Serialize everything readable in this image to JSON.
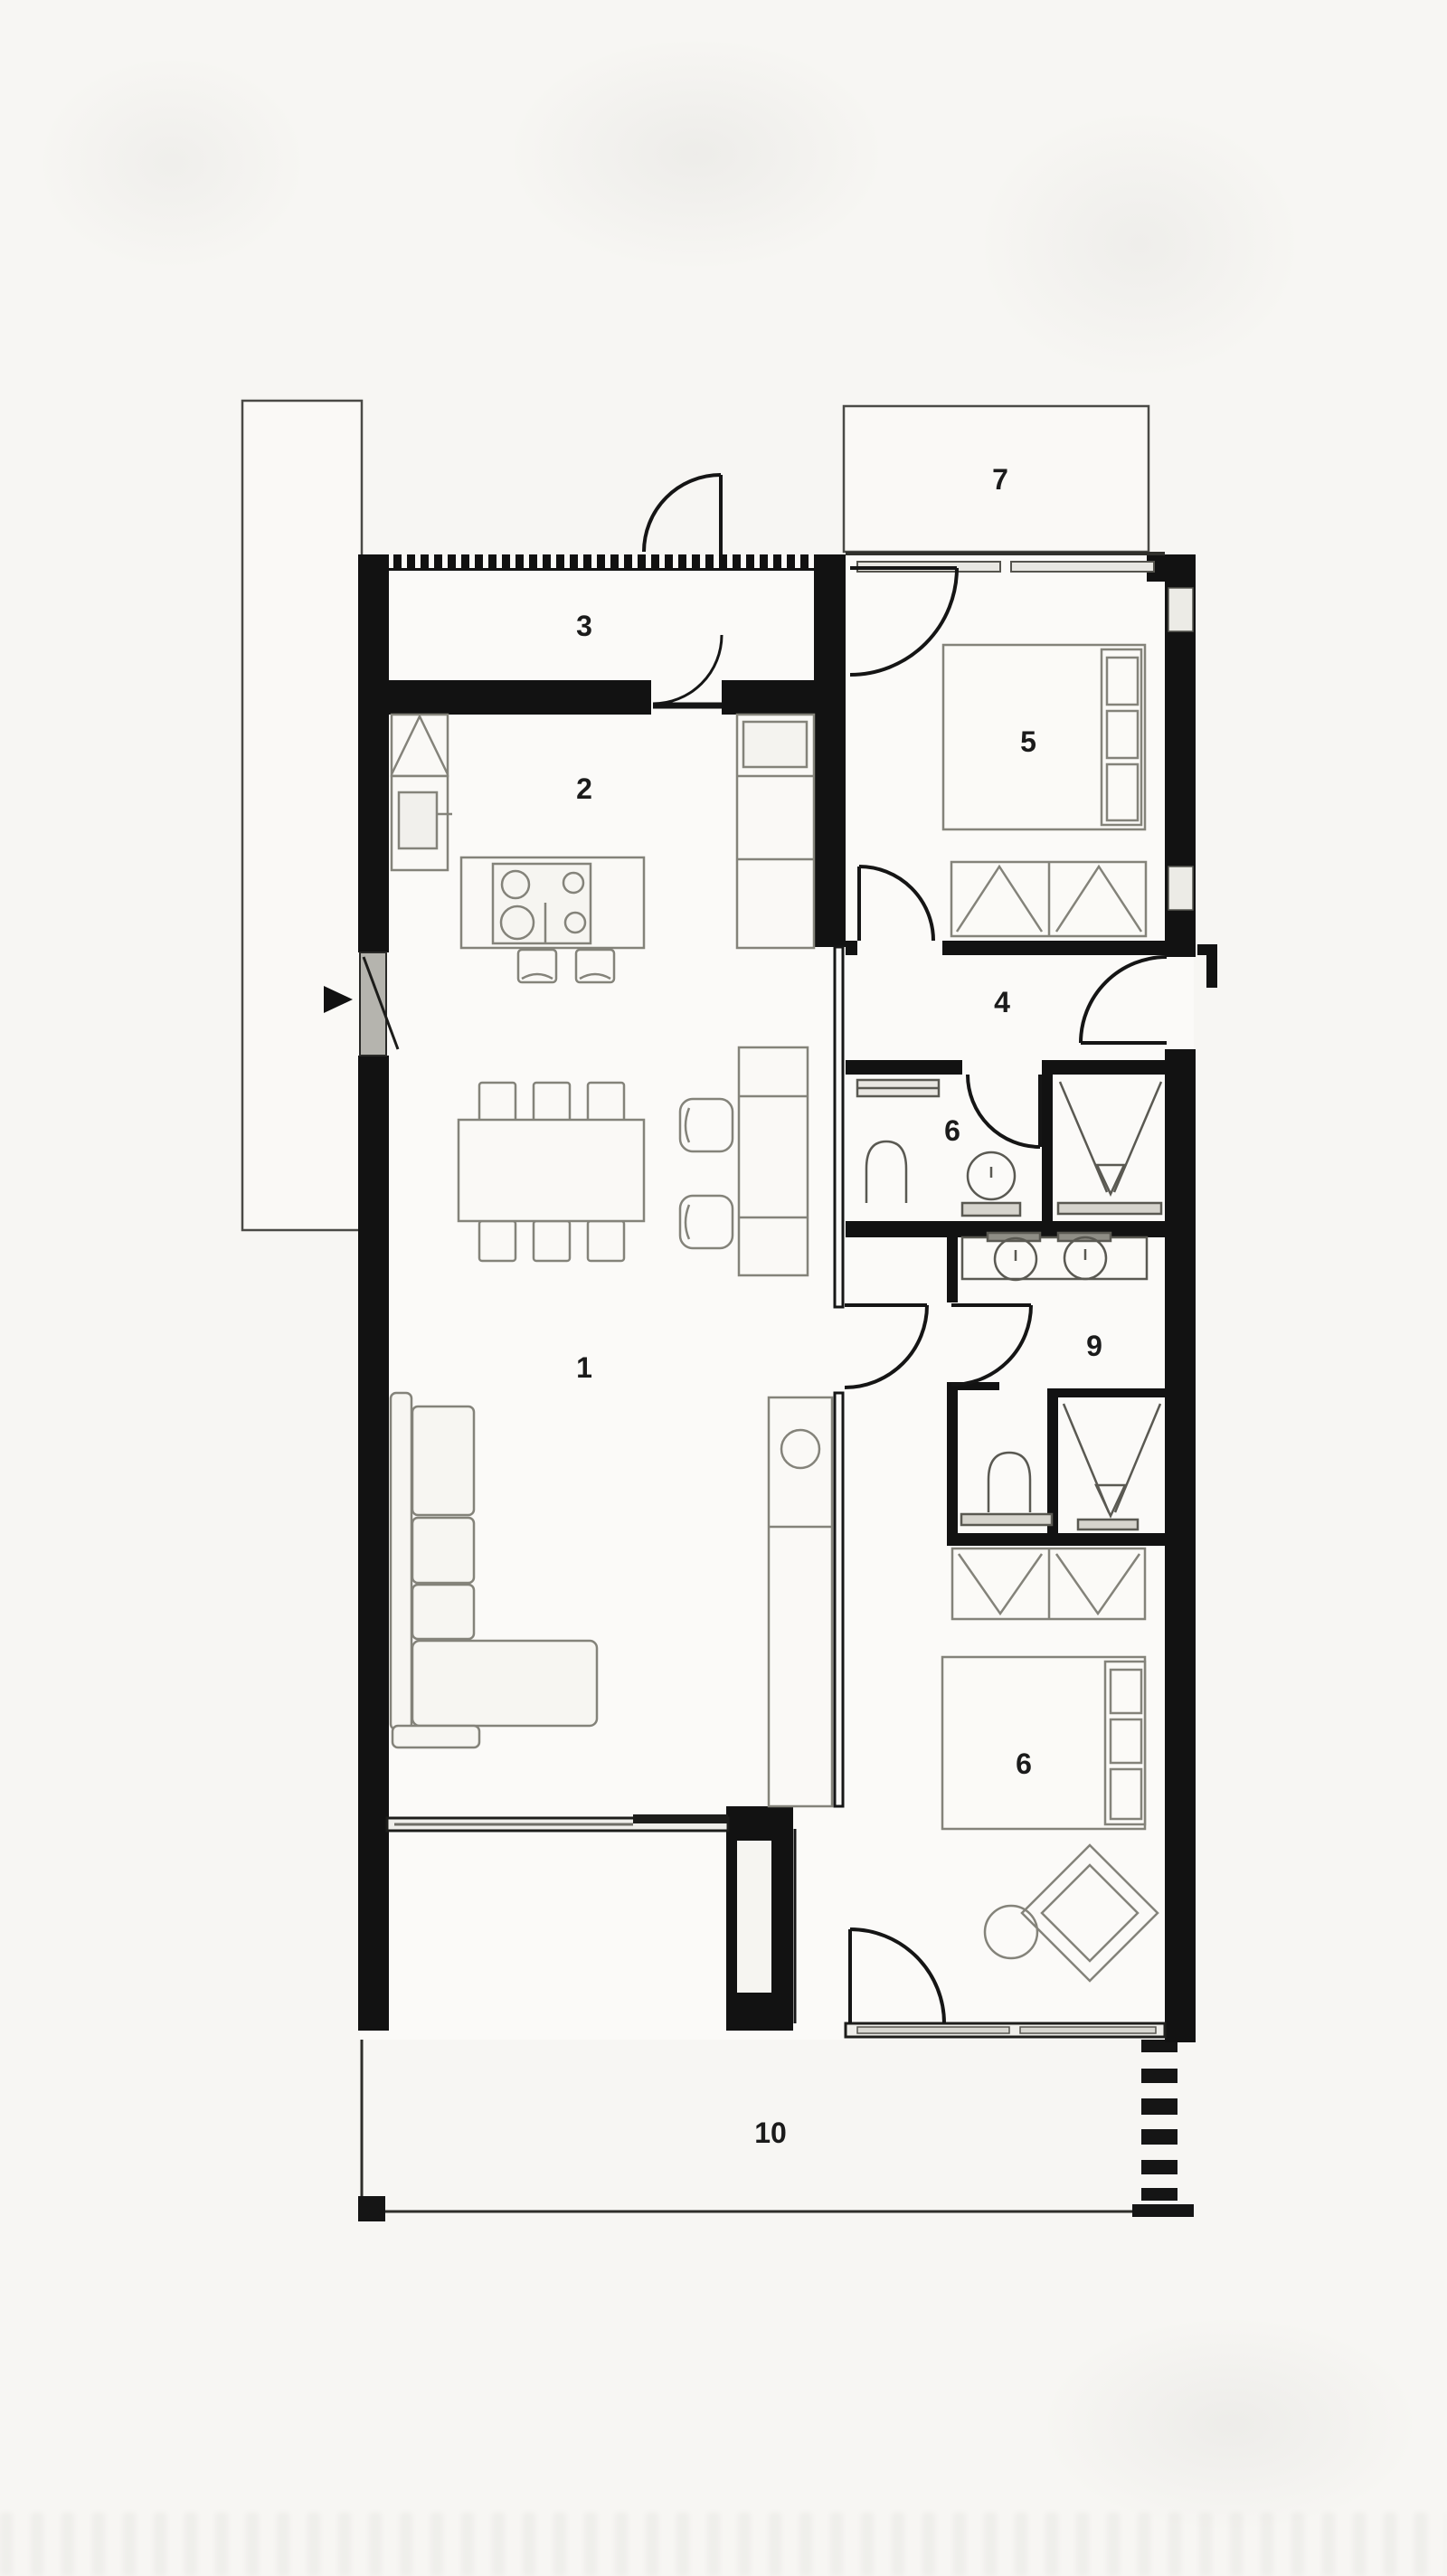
{
  "plan": {
    "type": "architectural-floor-plan",
    "rooms": [
      {
        "label": "1"
      },
      {
        "label": "2"
      },
      {
        "label": "3"
      },
      {
        "label": "4"
      },
      {
        "label": "5"
      },
      {
        "label": "6"
      },
      {
        "label": "7"
      },
      {
        "label": "9"
      },
      {
        "label": "6"
      },
      {
        "label": "10"
      }
    ],
    "icons": {
      "direction_marker": "triangle-right",
      "door": "quarter-arc",
      "shower_drain": "triangle",
      "cooktop": "four-burners"
    },
    "colors": {
      "background": "#f7f6f3",
      "interior_fill": "#fbfaf8",
      "wall": "#121212",
      "furniture_line": "#8b8a80",
      "glass": "#b5b4ae",
      "fixture_base": "#d6d4cd",
      "label": "#1b1b1b"
    }
  }
}
